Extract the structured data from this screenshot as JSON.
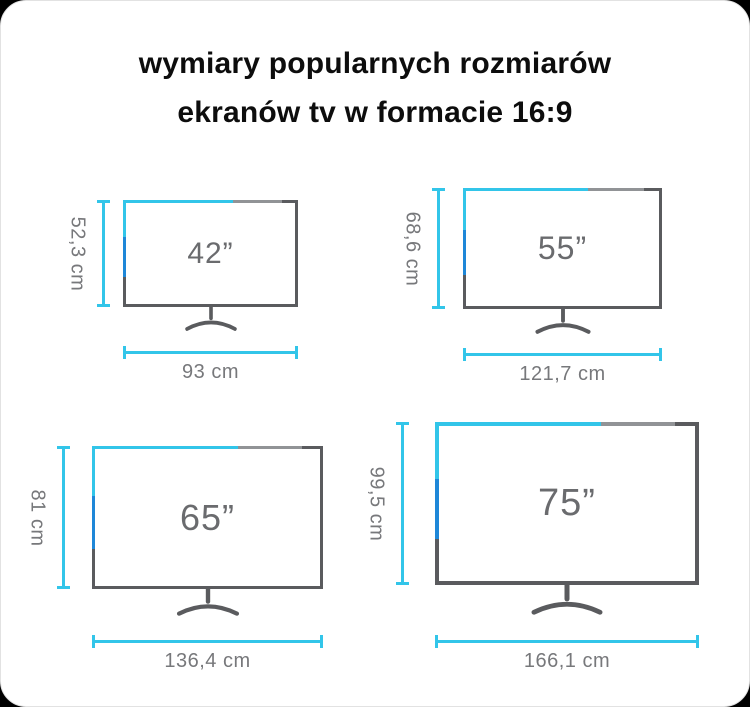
{
  "page": {
    "title_line1": "wymiary popularnych rozmiarów",
    "title_line2": "ekranów tv w formacie 16:9"
  },
  "tvs": [
    {
      "size_label": "42”",
      "height_label": "52,3 cm",
      "width_label": "93 cm"
    },
    {
      "size_label": "55”",
      "height_label": "68,6 cm",
      "width_label": "121,7 cm"
    },
    {
      "size_label": "65”",
      "height_label": "81 cm",
      "width_label": "136,4 cm"
    },
    {
      "size_label": "75”",
      "height_label": "99,5 cm",
      "width_label": "166,1 cm"
    }
  ],
  "colors": {
    "accent_cyan": "#32c5e9",
    "accent_blue": "#1e87d8",
    "frame_gray": "#5a5b5e",
    "frame_light_gray": "#919396",
    "size_label_gray": "#6a6b6e",
    "dimension_text_gray": "#77787b",
    "background": "#000000",
    "card": "#ffffff"
  }
}
